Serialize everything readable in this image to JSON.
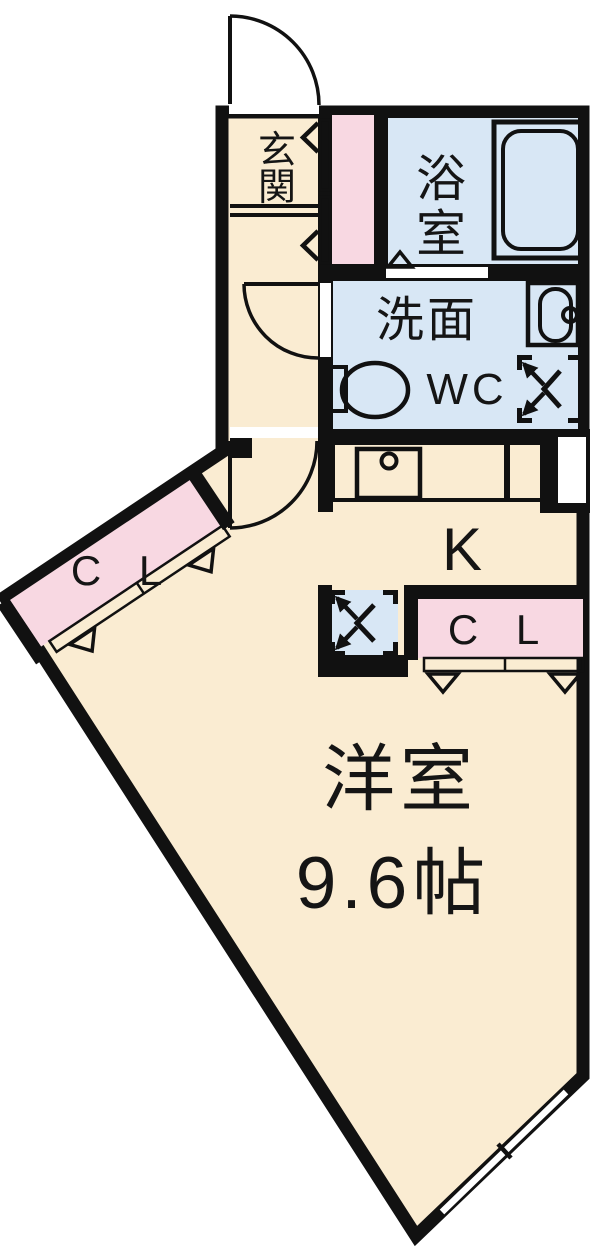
{
  "rooms": {
    "genkan": {
      "label": "玄関",
      "chars": [
        "玄",
        "関"
      ]
    },
    "bathroom": {
      "label": "浴室",
      "chars": [
        "浴",
        "室"
      ]
    },
    "washroom": {
      "label": "洗面"
    },
    "toilet": {
      "label": "WC"
    },
    "kitchen": {
      "label": "K"
    },
    "closet_left": {
      "label": "C L"
    },
    "closet_right": {
      "label": "C L"
    },
    "western_room": {
      "label": "洋室",
      "size": "9.6帖"
    }
  },
  "colors": {
    "wall": "#111111",
    "floor_cream": "#faecd2",
    "wet_area_blue": "#d8e7f5",
    "storage_pink": "#f8d8e2",
    "background": "#ffffff"
  }
}
